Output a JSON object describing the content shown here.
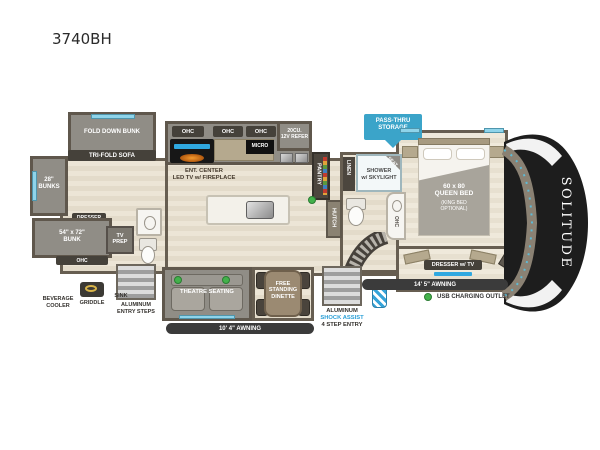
{
  "title": "3740BH",
  "brand": "SOLITUDE",
  "colors": {
    "wall": "#675e51",
    "slide_gray": "#908d86",
    "floor_beige": "#ece5d6",
    "accent_blue": "#3ba4c9",
    "window_blue": "#8fd4ea",
    "usb_green": "#43b14b",
    "front_cap": "#1d1d1d"
  },
  "labels": {
    "ohc": "OHC",
    "micro": "MICRO",
    "refer": "20CU.\n12V REFER",
    "ent_center": "ENT. CENTER\nLED TV w/ FIREPLACE",
    "pantry": "PANTRY",
    "hutch": "HUTCH",
    "linen": "LINEN",
    "shower": "SHOWER\nw/ SKYLIGHT",
    "seat": "SEAT",
    "fold_down_bunk": "FOLD DOWN BUNK",
    "tri_fold_sofa": "TRI-FOLD SOFA",
    "bunks_28": "28\"\nBUNKS",
    "dresser": "DRESSER",
    "bunk_54": "54\" x 72\"\nBUNK",
    "tv_prep": "TV\nPREP",
    "beverage_cooler": "BEVERAGE\nCOOLER",
    "griddle": "GRIDDLE",
    "sink": "SINK",
    "rear_steps": "ALUMINUM\nENTRY STEPS",
    "pass_thru": "PASS-THRU\nSTORAGE",
    "queen_bed": "60 x 80\nQUEEN BED",
    "king_opt": "(KING BED\nOPTIONAL)",
    "dresser_tv": "DRESSER w/ TV",
    "wd_prep": "WASHER/DRYER\nPREP",
    "theatre": "THEATRE SEATING",
    "dinette": "FREE\nSTANDING\nDINETTE",
    "awning_left": "10' 4\" AWNING",
    "awning_right": "14' 5\" AWNING",
    "entry_1": "ALUMINUM",
    "entry_2": "SHOCK ASSIST",
    "entry_3": "4 STEP ENTRY",
    "usb_legend": "USB CHARGING OUTLET"
  }
}
